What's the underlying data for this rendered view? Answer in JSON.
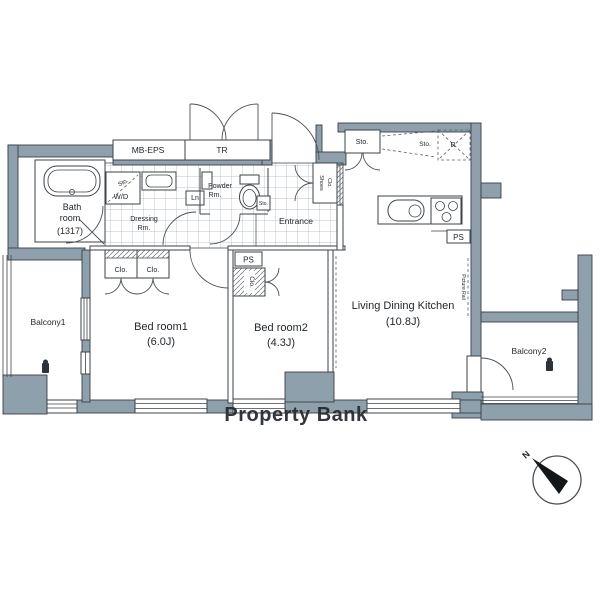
{
  "rooms": {
    "bath_l1": "Bath",
    "bath_l2": "room",
    "bath_size": "(1317)",
    "bedroom1_name": "Bed room1",
    "bedroom1_size": "(6.0J)",
    "bedroom2_name": "Bed room2",
    "bedroom2_size": "(4.3J)",
    "ldk_name": "Living Dining Kitchen",
    "ldk_size": "(10.8J)",
    "balcony1": "Balcony1",
    "balcony2": "Balcony2",
    "entrance": "Entrance",
    "dressing_l1": "Dressing",
    "dressing_l2": "Rm.",
    "powder_l1": "Powder",
    "powder_l2": "Rm."
  },
  "fixtures": {
    "mb_eps": "MB-EPS",
    "tr": "TR",
    "wd": "W/D",
    "wd_sto": "Sto.",
    "linen": "Ln",
    "toilet_sto": "Sto.",
    "shoes_l1": "Shoes",
    "shoes_l2": "Clo.",
    "clo_a": "Clo.",
    "clo_b": "Clo.",
    "clo_vert": "Clo.",
    "ps_bedroom2": "PS",
    "ps_kitchen": "PS",
    "sto_kitchen": "Sto.",
    "sto_open": "Sto.",
    "fridge": "R",
    "picture_rail": "Picture Rail"
  },
  "watermark": "Property Bank",
  "compass_n": "N",
  "colors": {
    "wall": "#8da0ac",
    "outline": "#3a4046",
    "watermark": "#d0d6db"
  }
}
